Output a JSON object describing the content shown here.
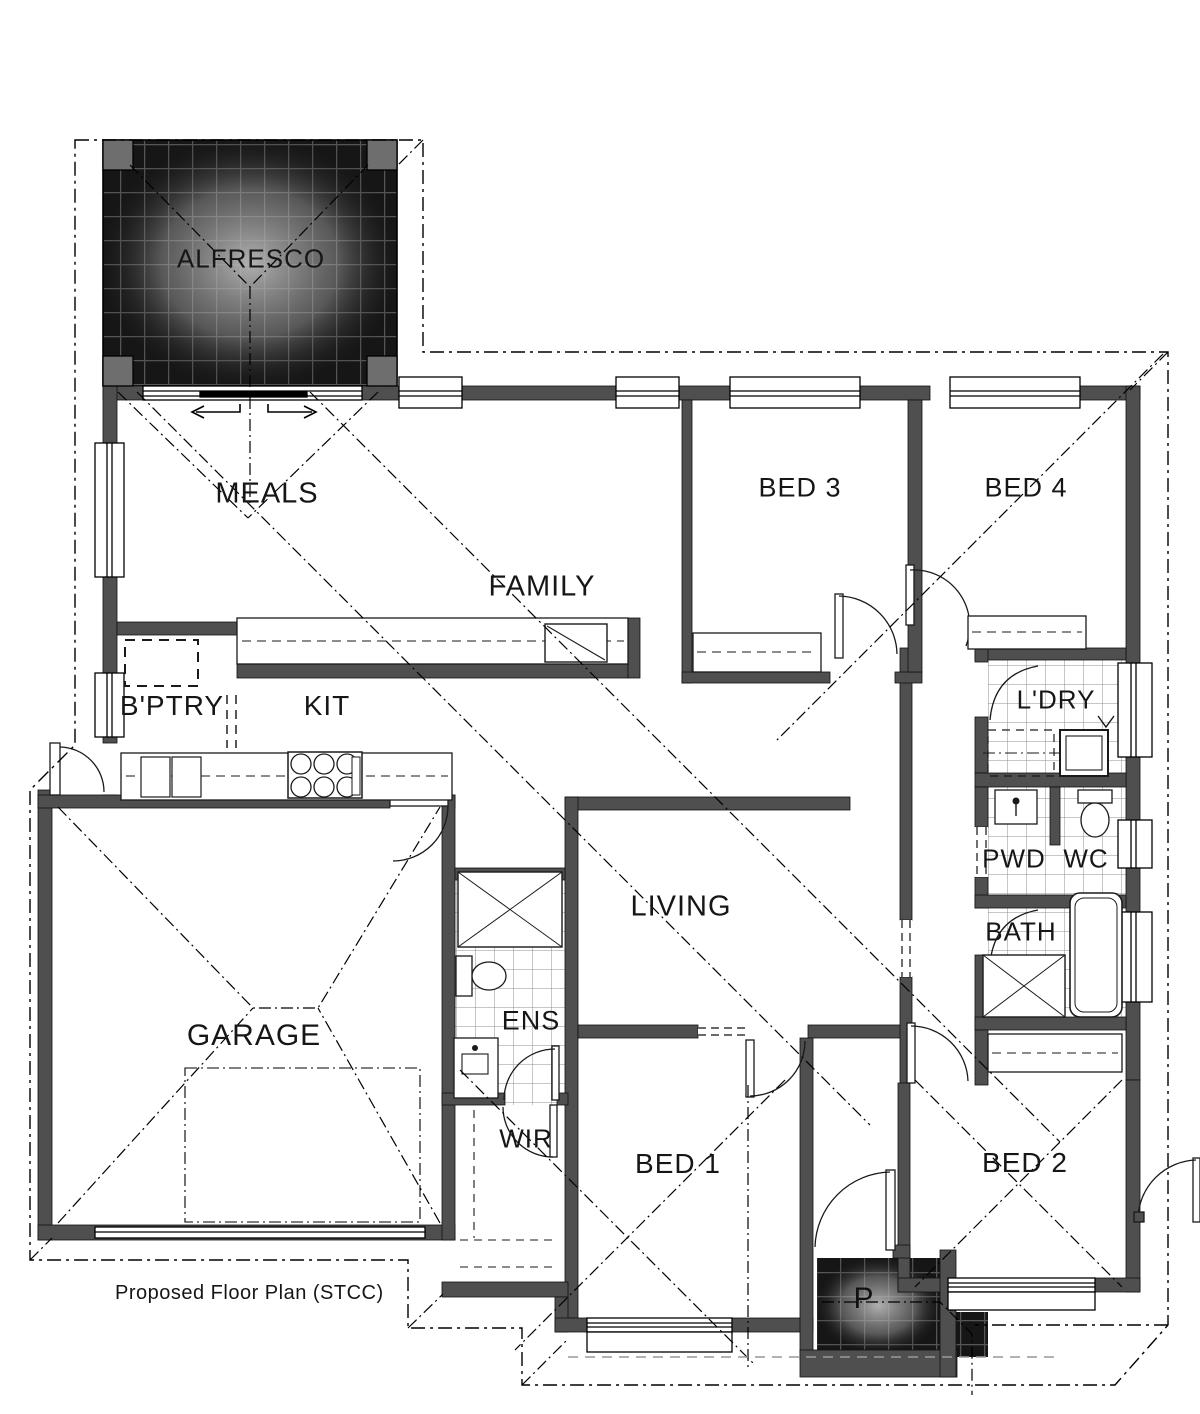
{
  "caption": "Proposed  Floor Plan (STCC)",
  "rooms": [
    {
      "id": "alfresco",
      "label": "ALFRESCO"
    },
    {
      "id": "meals",
      "label": "MEALS"
    },
    {
      "id": "family",
      "label": "FAMILY"
    },
    {
      "id": "bed3",
      "label": "BED 3"
    },
    {
      "id": "bed4",
      "label": "BED 4"
    },
    {
      "id": "bptry",
      "label": "B'PTRY"
    },
    {
      "id": "kit",
      "label": "KIT"
    },
    {
      "id": "ldry",
      "label": "L'DRY"
    },
    {
      "id": "living",
      "label": "LIVING"
    },
    {
      "id": "pwd",
      "label": "PWD"
    },
    {
      "id": "wc",
      "label": "WC"
    },
    {
      "id": "garage",
      "label": "GARAGE"
    },
    {
      "id": "ens",
      "label": "ENS"
    },
    {
      "id": "bath",
      "label": "BATH"
    },
    {
      "id": "wir",
      "label": "WIR"
    },
    {
      "id": "bed1",
      "label": "BED 1"
    },
    {
      "id": "bed2",
      "label": "BED 2"
    },
    {
      "id": "porch",
      "label": "P"
    }
  ],
  "colors": {
    "wall": "#4f4f4f",
    "line": "#1a1a1a",
    "dark_tile": "#161616",
    "dark_grout": "#555555",
    "light_tile_line": "#909090",
    "paper": "#ffffff"
  }
}
